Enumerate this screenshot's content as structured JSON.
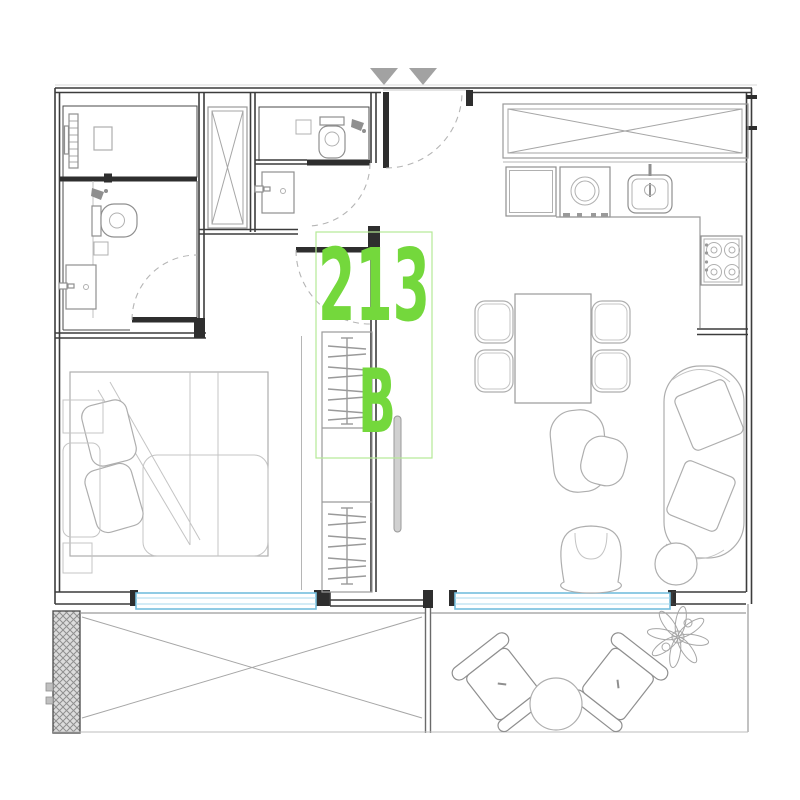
{
  "title": "Apartment unit floor plan",
  "unit": {
    "number": "213",
    "block": "B"
  },
  "colors": {
    "label_green": "#74d83c",
    "label_box_green": "#b5e996",
    "window_blue": "#74bede",
    "wall_dark": "#3c3c3c",
    "furniture_gray": "#aeaeae",
    "arrow_gray": "#a2a2a2",
    "hatch_gray": "#8f8f8f"
  },
  "entry": {
    "arrows": [
      "down-triangle-icon",
      "down-triangle-icon"
    ],
    "door": "entry-door-swing"
  },
  "rooms": [
    {
      "name": "laundry-room",
      "fixtures": [
        "utility-panel",
        "appliance-box"
      ]
    },
    {
      "name": "bathroom-1",
      "fixtures": [
        "shower-head-icon",
        "toilet-icon",
        "vanity-sink-icon"
      ]
    },
    {
      "name": "shaft",
      "fixtures": [
        "x-braced-duct"
      ]
    },
    {
      "name": "bathroom-2",
      "fixtures": [
        "toilet-icon",
        "shower-head-icon",
        "vanity-sink-icon"
      ]
    },
    {
      "name": "kitchen",
      "fixtures": [
        "upper-cabinets",
        "fridge-icon",
        "washer-icon",
        "sink-icon",
        "gas-stove-icon"
      ]
    },
    {
      "name": "dining-area",
      "fixtures": [
        "dining-table",
        "chair",
        "chair",
        "chair",
        "chair"
      ]
    },
    {
      "name": "living-area",
      "fixtures": [
        "coffee-table",
        "coffee-table",
        "armchair",
        "sofa",
        "side-table"
      ]
    },
    {
      "name": "bedroom",
      "fixtures": [
        "double-bed",
        "pillows",
        "nightstand",
        "dresser"
      ]
    },
    {
      "name": "closet",
      "fixtures": [
        "hanger-rod",
        "hanger-rod"
      ]
    },
    {
      "name": "balcony-left",
      "fixtures": [
        "x-marked-floor",
        "hatched-wall"
      ]
    },
    {
      "name": "balcony-right",
      "fixtures": [
        "outdoor-chair",
        "outdoor-chair",
        "round-table",
        "plant-icon"
      ]
    }
  ],
  "windows": [
    "bedroom-window",
    "living-room-window"
  ]
}
